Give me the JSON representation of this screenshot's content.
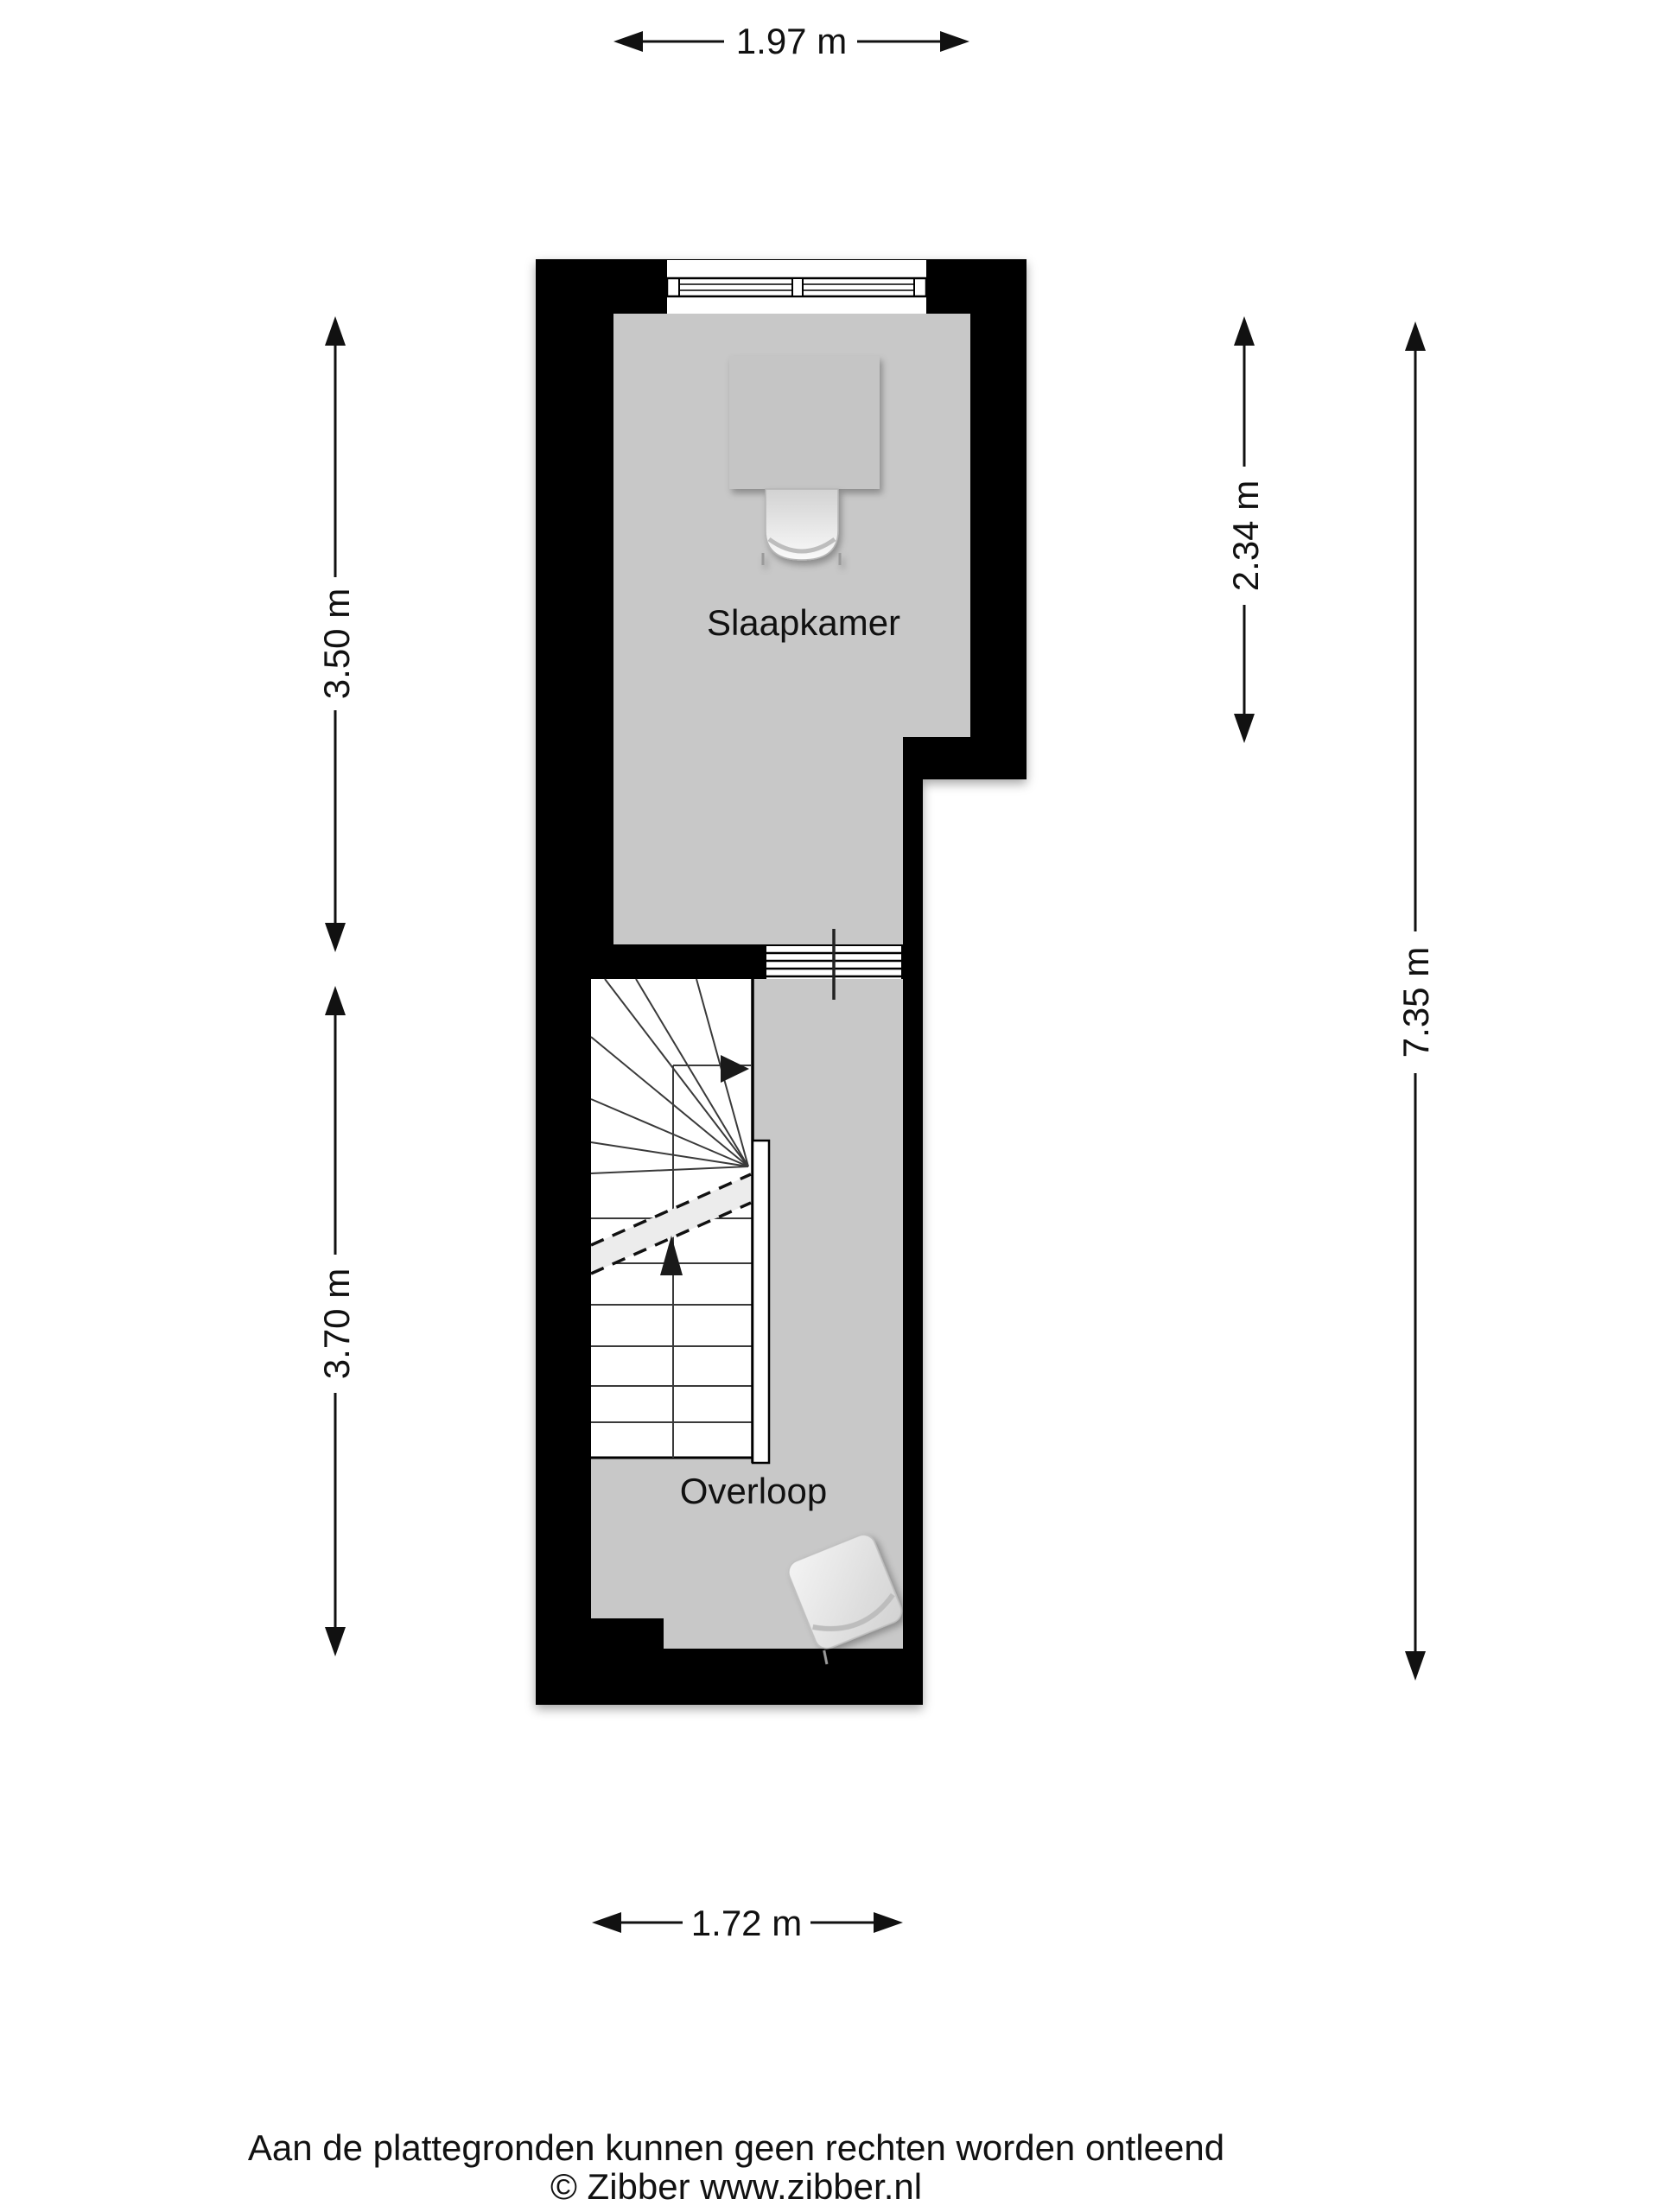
{
  "floorplan": {
    "type": "floor-plan",
    "labels": {
      "slaapkamer": "Slaapkamer",
      "overloop": "Overloop"
    },
    "dimensions": {
      "top_width": "1.97 m",
      "left_upper_height": "3.50 m",
      "left_lower_height": "3.70 m",
      "right_upper_height": "2.34 m",
      "right_total_height": "7.35 m",
      "bottom_width": "1.72 m"
    },
    "symbols": [
      "window",
      "glazed-partition",
      "staircase",
      "stair-direction-arrows",
      "desk",
      "desk-chair",
      "chair"
    ],
    "colors": {
      "wall": "#000000",
      "floor": "#c8c8c8",
      "stairwell": "#ffffff",
      "text": "#111111",
      "background": "#ffffff"
    }
  },
  "footer": {
    "disclaimer": "Aan de plattegronden kunnen geen rechten worden ontleend",
    "copyright": "© Zibber www.zibber.nl"
  }
}
